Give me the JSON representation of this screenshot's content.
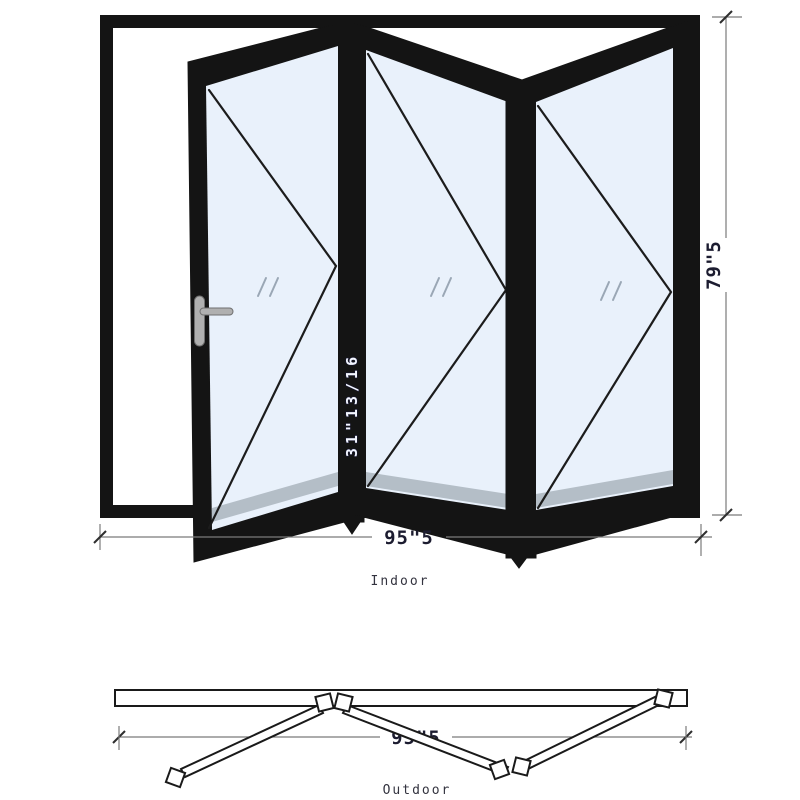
{
  "elevation": {
    "width_label": "95\"5",
    "height_label": "79\"5",
    "panel_width_label": "31\"13/16",
    "side_label": "Indoor",
    "panel_count": 3
  },
  "plan": {
    "width_label": "95\"5",
    "side_label": "Outdoor"
  },
  "colors": {
    "frame": "#141414",
    "glass": "#e9f1fb",
    "sill_band": "#b4bec7",
    "dimension_line": "#7a7a7a",
    "dimension_text": "#1c1c30",
    "handle": "#b0b0b0"
  }
}
